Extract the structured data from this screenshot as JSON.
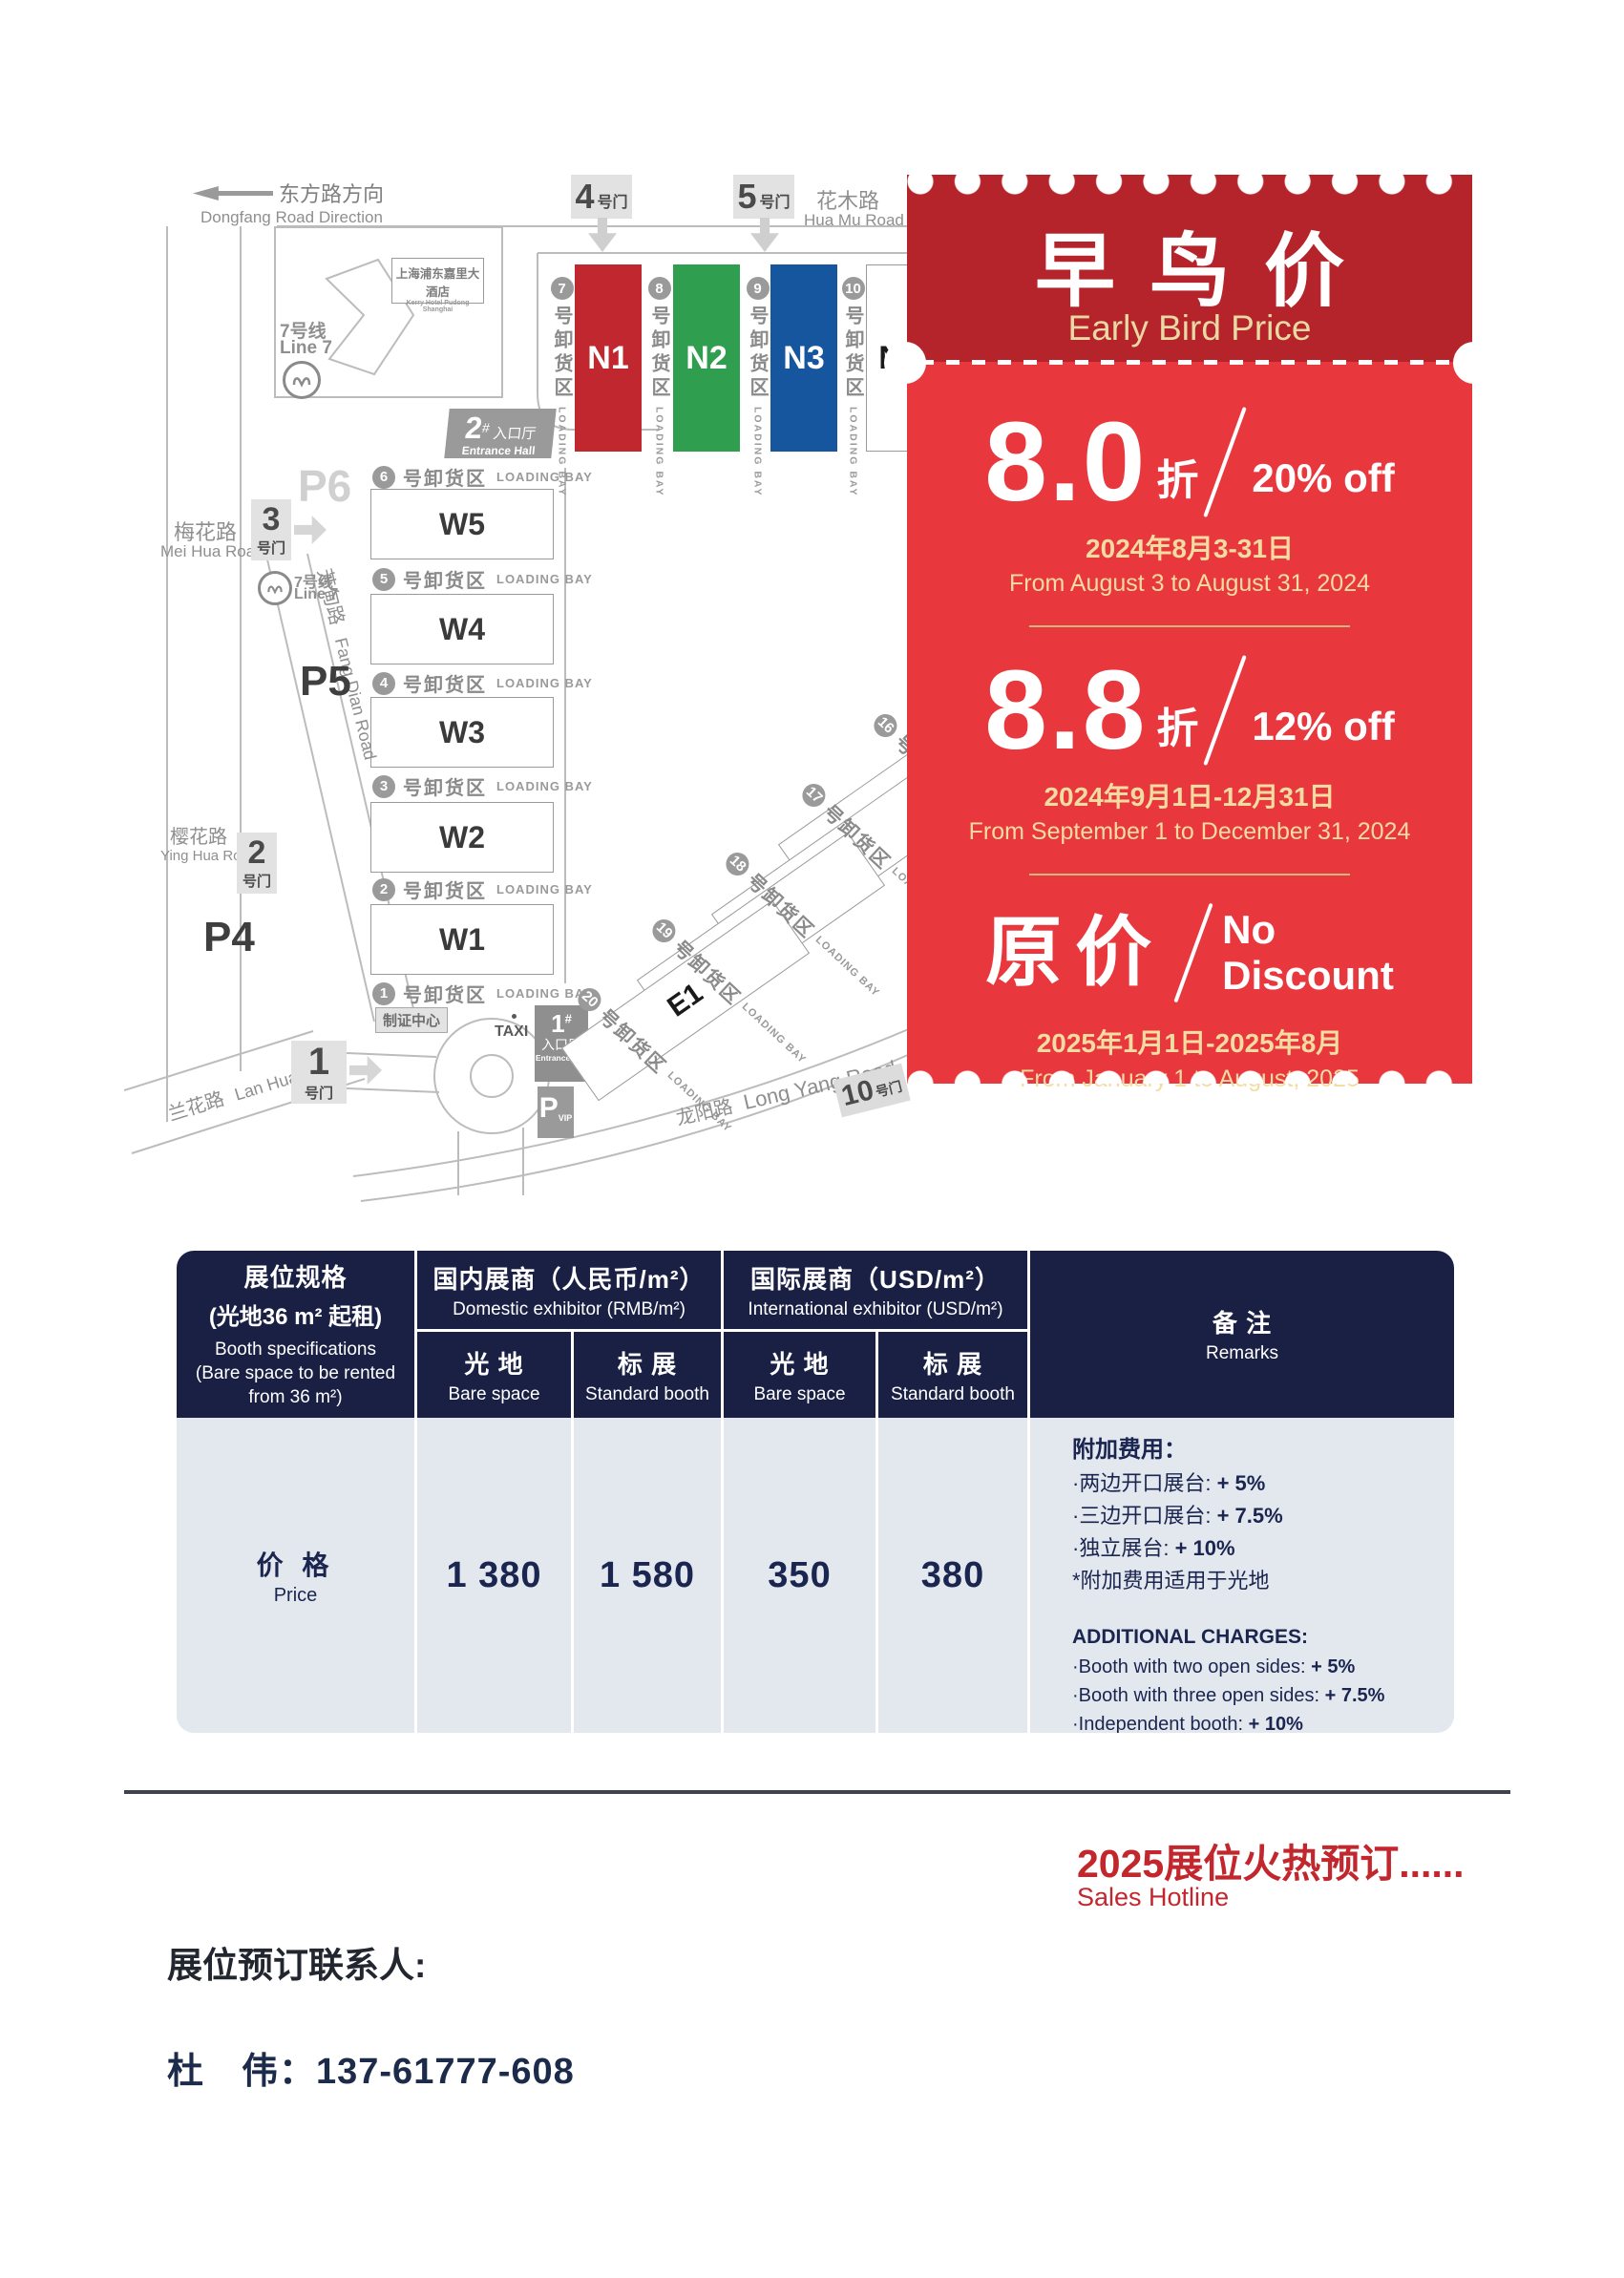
{
  "map": {
    "direction": {
      "zh": "东方路方向",
      "en": "Dongfang Road Direction"
    },
    "huamu": {
      "zh": "花木路",
      "en": "Hua Mu Road"
    },
    "meihua": {
      "zh": "梅花路",
      "en": "Mei Hua Road"
    },
    "fangdian": {
      "zh": "芳甸路",
      "en": "Fang Dian Road"
    },
    "yinghua": {
      "zh": "樱花路",
      "en": "Ying Hua Road"
    },
    "lanhua": {
      "zh": "兰花路",
      "en": "Lan Hua Road"
    },
    "longyang": {
      "zh": "龙阳路",
      "en": "Long Yang Road"
    },
    "hotel": {
      "zh": "上海浦东嘉里大酒店",
      "en": "Kerry Hotel Pudong Shanghai"
    },
    "metro": {
      "zh": "7号线",
      "en": "Line 7"
    },
    "gates": {
      "g1": {
        "num": "1",
        "sfx": "号门"
      },
      "g2": {
        "num": "2",
        "sfx": "号门"
      },
      "g3": {
        "num": "3",
        "sfx": "号门"
      },
      "g4": {
        "num": "4",
        "sfx": "号门"
      },
      "g5": {
        "num": "5",
        "sfx": "号门"
      },
      "g10": {
        "num": "10",
        "sfx": "号门"
      }
    },
    "parking": {
      "p4": "P4",
      "p5": "P5",
      "p6": "P6",
      "vip": "P",
      "vip_sub": "VIP"
    },
    "entrance1": {
      "num": "1",
      "hash": "#",
      "zh": "入口厅",
      "en": "Entrance Hall"
    },
    "entrance2": {
      "num": "2",
      "hash": "#",
      "zh": "入口厅",
      "en": "Entrance Hall"
    },
    "badge_zhizheng": "制证中心",
    "taxi": "TAXI",
    "loading": {
      "zh": "号卸货区",
      "en": "LOADING BAY"
    },
    "halls_n": [
      {
        "id": "N1",
        "color": "#C0272E"
      },
      {
        "id": "N2",
        "color": "#2F9E4E"
      },
      {
        "id": "N3",
        "color": "#15569F"
      },
      {
        "id": "N4",
        "color": "#FFFFFF"
      }
    ],
    "n_bays": [
      "7",
      "8",
      "9",
      "10"
    ],
    "halls_w": [
      "W5",
      "W4",
      "W3",
      "W2",
      "W1"
    ],
    "w_bays": [
      "6",
      "5",
      "4",
      "3",
      "2",
      "1"
    ],
    "halls_e": [
      "E4",
      "E3",
      "E2",
      "E1"
    ],
    "e_bays": [
      "16",
      "17",
      "18",
      "19",
      "20"
    ]
  },
  "ticket": {
    "accent_dark": "#B5242B",
    "accent_light": "#E8383E",
    "gold": "#F3DCA2",
    "title_zh": "早鸟价",
    "title_en": "Early Bird Price",
    "tiers": [
      {
        "big": "8.0",
        "unit": "折",
        "off": "20% off",
        "date_zh": "2024年8月3-31日",
        "date_en": "From August 3 to August 31, 2024"
      },
      {
        "big": "8.8",
        "unit": "折",
        "off": "12% off",
        "date_zh": "2024年9月1日-12月31日",
        "date_en": "From September 1 to December 31, 2024"
      },
      {
        "big": "原价",
        "off1": "No",
        "off2": "Discount",
        "date_zh": "2025年1月1日-2025年8月",
        "date_en": "From January 1 to August, 2025"
      }
    ]
  },
  "table": {
    "header_bg": "#1A2044",
    "body_bg": "#E3E7EE",
    "spec": {
      "zh1": "展位规格",
      "zh2": "(光地36 m² 起租)",
      "en1": "Booth specifications",
      "en2": "(Bare space to be rented from 36 m²)"
    },
    "domestic": {
      "zh": "国内展商（人民币/m²）",
      "en": "Domestic exhibitor (RMB/m²)"
    },
    "intl": {
      "zh": "国际展商（USD/m²）",
      "en": "International exhibitor (USD/m²)"
    },
    "bare": {
      "zh": "光 地",
      "en": "Bare space"
    },
    "standard": {
      "zh": "标 展",
      "en": "Standard booth"
    },
    "remarks_hdr": {
      "zh": "备 注",
      "en": "Remarks"
    },
    "price_row": {
      "zh": "价 格",
      "en": "Price",
      "values": [
        "1 380",
        "1 580",
        "350",
        "380"
      ]
    },
    "remarks": {
      "zh_title": "附加费用：",
      "zh_items": [
        {
          "label": "·两边开口展台: ",
          "value": "+ 5%"
        },
        {
          "label": "·三边开口展台: ",
          "value": "+ 7.5%"
        },
        {
          "label": "·独立展台: ",
          "value": "+ 10%"
        }
      ],
      "zh_note": "*附加费用适用于光地",
      "en_title": "ADDITIONAL CHARGES:",
      "en_items": [
        {
          "label": "·Booth with two open sides: ",
          "value": "+ 5%"
        },
        {
          "label": "·Booth with three open sides: ",
          "value": "+ 7.5%"
        },
        {
          "label": "·Independent booth: ",
          "value": "+ 10%"
        }
      ],
      "en_note": "*Additional charges apply to bare space"
    }
  },
  "footer": {
    "sales_zh": "2025展位火热预订......",
    "sales_en": "Sales Hotline",
    "contact_label": "展位预订联系人:",
    "contact_phone": "杜　伟：137-61777-608"
  }
}
